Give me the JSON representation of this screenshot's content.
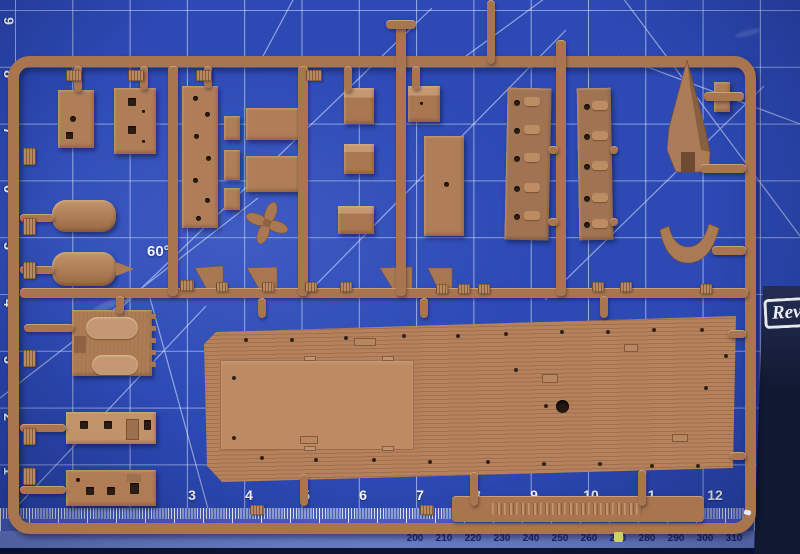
{
  "scene": {
    "description": "Brown injection-molded plastic model kit sprue (Revell ship kit) lying on a blue self-healing cutting mat; corner of the dark-blue Revell kit box visible at lower right",
    "angle_label": "60°",
    "box_logo_text": "Rev"
  },
  "colors": {
    "mat_blue": "#2c49b4",
    "mat_grid_line": "#e2ebff",
    "ruler_tick_strip": "#4c64c2",
    "ruler_mm_strip": "#7289d6",
    "ruler_mm_number": "#1b2a70",
    "ruler_inch_number": "#ffffff",
    "mat_bottom_edge": "#0d1434",
    "sprue_plastic": "#a9754f",
    "sprue_plastic_light": "#bd8a63",
    "deck_plank_dark": "#a06f4c",
    "hole_dark": "#2c1d14",
    "box_navy": "#111831",
    "box_logo_white": "#eceef2"
  },
  "rulers": {
    "bottom_inches": [
      {
        "label": "0",
        "x": 14
      },
      {
        "label": "1",
        "x": 78
      },
      {
        "label": "2",
        "x": 135
      },
      {
        "label": "3",
        "x": 192
      },
      {
        "label": "4",
        "x": 249
      },
      {
        "label": "5",
        "x": 306
      },
      {
        "label": "6",
        "x": 363
      },
      {
        "label": "7",
        "x": 420
      },
      {
        "label": "8",
        "x": 477
      },
      {
        "label": "9",
        "x": 534
      },
      {
        "label": "10",
        "x": 591
      },
      {
        "label": "11",
        "x": 648
      },
      {
        "label": "12",
        "x": 715
      },
      {
        "label": "13",
        "x": 768
      }
    ],
    "left_inches": [
      {
        "label": "9",
        "y": 13
      },
      {
        "label": "8",
        "y": 66
      },
      {
        "label": "7",
        "y": 123
      },
      {
        "label": "6",
        "y": 181
      },
      {
        "label": "5",
        "y": 238
      },
      {
        "label": "4",
        "y": 295
      },
      {
        "label": "3",
        "y": 352
      },
      {
        "label": "2",
        "y": 409
      },
      {
        "label": "1",
        "y": 463
      },
      {
        "label": "0",
        "y": 512
      }
    ],
    "bottom_mm": [
      {
        "label": "200",
        "x": 415
      },
      {
        "label": "210",
        "x": 444
      },
      {
        "label": "220",
        "x": 473
      },
      {
        "label": "230",
        "x": 502
      },
      {
        "label": "240",
        "x": 531
      },
      {
        "label": "250",
        "x": 560
      },
      {
        "label": "260",
        "x": 589
      },
      {
        "label": "270",
        "x": 618
      },
      {
        "label": "280",
        "x": 647
      },
      {
        "label": "290",
        "x": 676
      },
      {
        "label": "300",
        "x": 705
      },
      {
        "label": "310",
        "x": 734
      },
      {
        "label": "320",
        "x": 763
      },
      {
        "label": "330",
        "x": 792
      }
    ]
  },
  "parts_manifest": [
    {
      "name": "main-deck",
      "desc": "large planked ship deck with hatches and portholes"
    },
    {
      "name": "propeller",
      "desc": "four-blade propeller"
    },
    {
      "name": "bow-spire",
      "desc": "pointed bow/prow piece"
    },
    {
      "name": "v-saddle",
      "desc": "V-shaped saddle bracket"
    },
    {
      "name": "lifeboat-1",
      "desc": "lifeboat hull"
    },
    {
      "name": "lifeboat-2",
      "desc": "lifeboat hull with pointed stern"
    },
    {
      "name": "hatch-cover",
      "desc": "textured hatch cover with two oval pads"
    },
    {
      "name": "deckhouse-wall-1",
      "desc": "deckhouse wall with window and door openings"
    },
    {
      "name": "deckhouse-wall-2",
      "desc": "deckhouse wall with window and door openings"
    },
    {
      "name": "side-wall-1",
      "desc": "long superstructure wall with portholes"
    },
    {
      "name": "side-wall-2",
      "desc": "long superstructure wall with portholes"
    },
    {
      "name": "flat-plates",
      "desc": "assorted flat plates with holes"
    },
    {
      "name": "small-boxes",
      "desc": "assorted small box-shaped parts"
    }
  ]
}
